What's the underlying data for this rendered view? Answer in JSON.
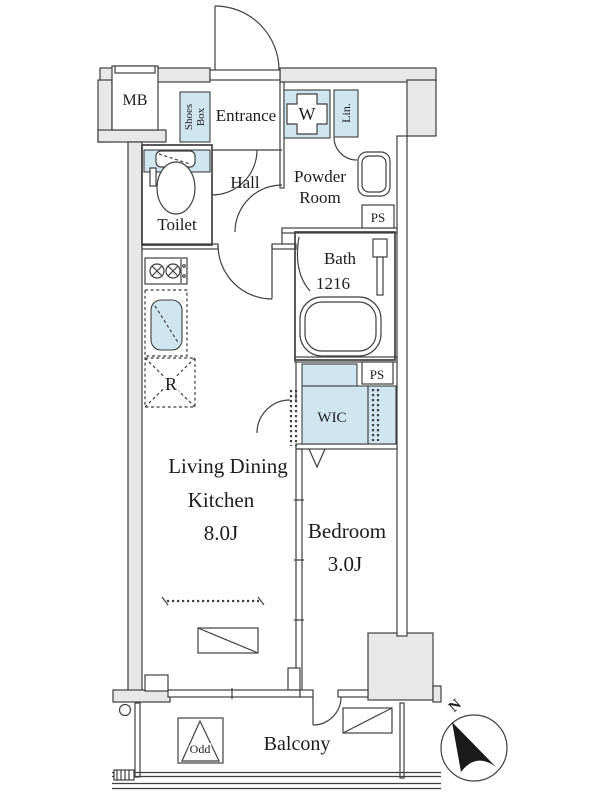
{
  "labels": {
    "mb": "MB",
    "shoes_box_1": "Shoes",
    "shoes_box_2": "Box",
    "entrance": "Entrance",
    "washer": "W",
    "linen": "Lin.",
    "toilet": "Toilet",
    "hall": "Hall",
    "powder_1": "Powder",
    "powder_2": "Room",
    "ps_top": "PS",
    "ps_mid": "PS",
    "bath_1": "Bath",
    "bath_2": "1216",
    "wic": "WIC",
    "ldk_1": "Living Dining",
    "ldk_2": "Kitchen",
    "ldk_size": "8.0J",
    "bedroom": "Bedroom",
    "bedroom_size": "3.0J",
    "fridge": "R",
    "balcony": "Balcony",
    "odd": "Odd",
    "north": "N"
  },
  "colors": {
    "wall_fill": "#e8e8e8",
    "fixture_blue": "#cfe5f0",
    "line": "#3f3f3f",
    "compass_arrow": "#1a1a1a"
  }
}
